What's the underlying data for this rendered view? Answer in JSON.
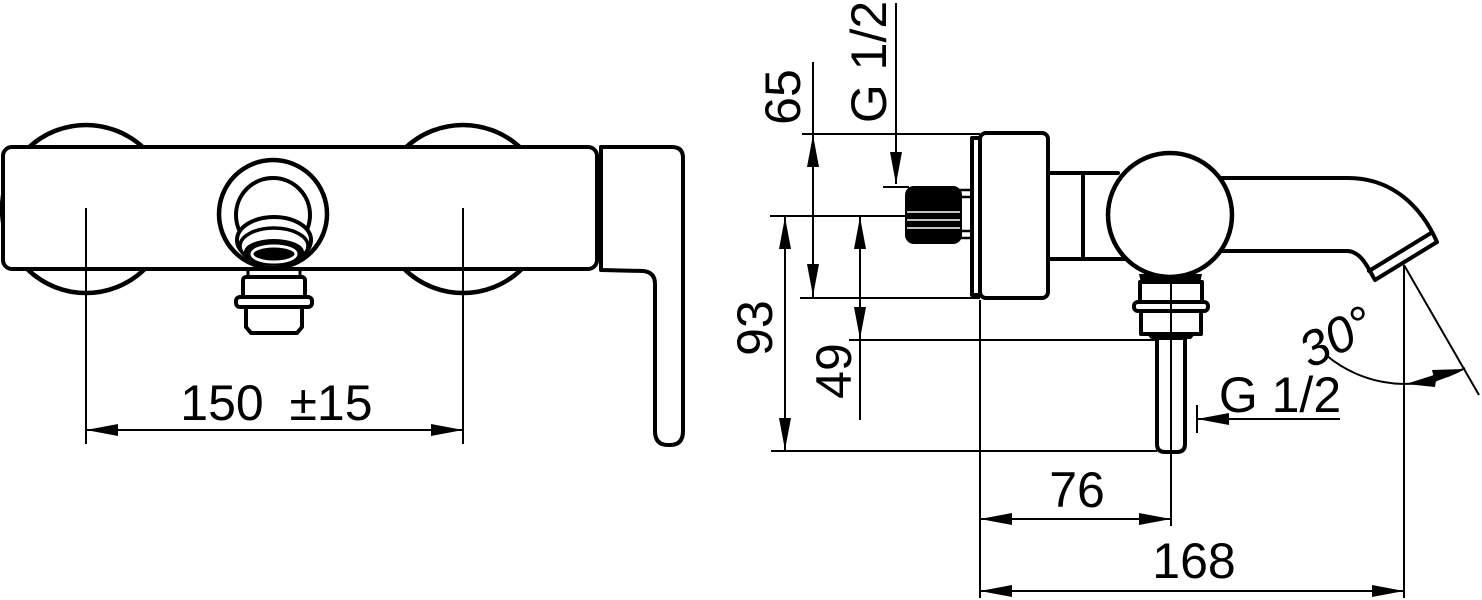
{
  "drawing": {
    "front_view": {
      "dim_center_distance": "150",
      "dim_center_distance_tolerance": "±15"
    },
    "side_view": {
      "dim_plate_height": "65",
      "label_inlet_thread": "G 1/2",
      "dim_axis_to_outlet_end": "93",
      "dim_axis_to_nut": "49",
      "label_outlet_thread": "G 1/2",
      "dim_wall_to_outlet_axis": "76",
      "dim_wall_to_spout_tip": "168",
      "dim_spout_angle": "30°"
    }
  }
}
